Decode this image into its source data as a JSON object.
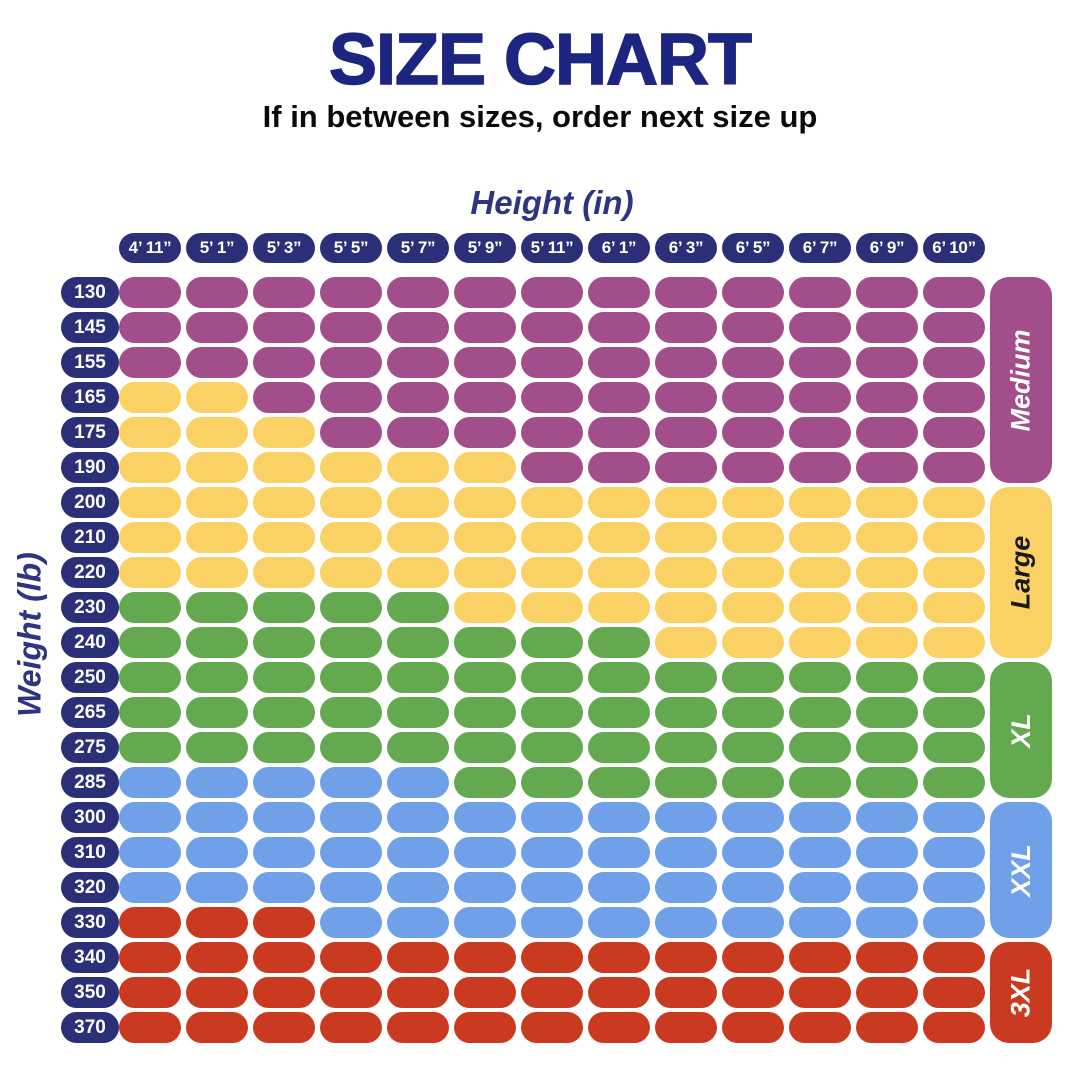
{
  "page": {
    "title": "SIZE CHART",
    "subtitle": "If in between sizes, order next size up"
  },
  "colors": {
    "background": "#FFFFFF",
    "title_text": "#1C2580",
    "subtitle_text": "#0A0A0A",
    "axis_label_text": "#2D3480",
    "tick_pill": "#2B2F78",
    "tick_text": "#FFFFFF"
  },
  "chart_data": {
    "type": "heatmap",
    "title": "SIZE CHART",
    "subtitle": "If in between sizes, order next size up",
    "xlabel": "Height (in)",
    "ylabel": "Weight (lb)",
    "legend_position": "right",
    "grid": "off",
    "x_categories": [
      "4’ 11”",
      "5’ 1”",
      "5’ 3”",
      "5’ 5”",
      "5’ 7”",
      "5’ 9”",
      "5’ 11”",
      "6’ 1”",
      "6’ 3”",
      "6’ 5”",
      "6’ 7”",
      "6’ 9”",
      "6’ 10”"
    ],
    "y_categories": [
      "130",
      "145",
      "155",
      "165",
      "175",
      "190",
      "200",
      "210",
      "220",
      "230",
      "240",
      "250",
      "265",
      "275",
      "285",
      "300",
      "310",
      "320",
      "330",
      "340",
      "350",
      "370"
    ],
    "sizes": [
      {
        "code": "M",
        "label": "Medium",
        "color": "#A14E8A",
        "text_color": "#FFFFFF",
        "row_start": 0,
        "row_end": 5
      },
      {
        "code": "L",
        "label": "Large",
        "color": "#FAD164",
        "text_color": "#1A1A1A",
        "row_start": 6,
        "row_end": 10
      },
      {
        "code": "XL",
        "label": "XL",
        "color": "#64A850",
        "text_color": "#FFFFFF",
        "row_start": 11,
        "row_end": 14
      },
      {
        "code": "XXL",
        "label": "XXL",
        "color": "#6FA0E8",
        "text_color": "#FFFFFF",
        "row_start": 15,
        "row_end": 18
      },
      {
        "code": "3XL",
        "label": "3XL",
        "color": "#C93A20",
        "text_color": "#FFFFFF",
        "row_start": 19,
        "row_end": 21
      }
    ],
    "matrix": [
      [
        "M",
        "M",
        "M",
        "M",
        "M",
        "M",
        "M",
        "M",
        "M",
        "M",
        "M",
        "M",
        "M"
      ],
      [
        "M",
        "M",
        "M",
        "M",
        "M",
        "M",
        "M",
        "M",
        "M",
        "M",
        "M",
        "M",
        "M"
      ],
      [
        "M",
        "M",
        "M",
        "M",
        "M",
        "M",
        "M",
        "M",
        "M",
        "M",
        "M",
        "M",
        "M"
      ],
      [
        "L",
        "L",
        "M",
        "M",
        "M",
        "M",
        "M",
        "M",
        "M",
        "M",
        "M",
        "M",
        "M"
      ],
      [
        "L",
        "L",
        "L",
        "M",
        "M",
        "M",
        "M",
        "M",
        "M",
        "M",
        "M",
        "M",
        "M"
      ],
      [
        "L",
        "L",
        "L",
        "L",
        "L",
        "L",
        "M",
        "M",
        "M",
        "M",
        "M",
        "M",
        "M"
      ],
      [
        "L",
        "L",
        "L",
        "L",
        "L",
        "L",
        "L",
        "L",
        "L",
        "L",
        "L",
        "L",
        "L"
      ],
      [
        "L",
        "L",
        "L",
        "L",
        "L",
        "L",
        "L",
        "L",
        "L",
        "L",
        "L",
        "L",
        "L"
      ],
      [
        "L",
        "L",
        "L",
        "L",
        "L",
        "L",
        "L",
        "L",
        "L",
        "L",
        "L",
        "L",
        "L"
      ],
      [
        "XL",
        "XL",
        "XL",
        "XL",
        "XL",
        "L",
        "L",
        "L",
        "L",
        "L",
        "L",
        "L",
        "L"
      ],
      [
        "XL",
        "XL",
        "XL",
        "XL",
        "XL",
        "XL",
        "XL",
        "XL",
        "L",
        "L",
        "L",
        "L",
        "L"
      ],
      [
        "XL",
        "XL",
        "XL",
        "XL",
        "XL",
        "XL",
        "XL",
        "XL",
        "XL",
        "XL",
        "XL",
        "XL",
        "XL"
      ],
      [
        "XL",
        "XL",
        "XL",
        "XL",
        "XL",
        "XL",
        "XL",
        "XL",
        "XL",
        "XL",
        "XL",
        "XL",
        "XL"
      ],
      [
        "XL",
        "XL",
        "XL",
        "XL",
        "XL",
        "XL",
        "XL",
        "XL",
        "XL",
        "XL",
        "XL",
        "XL",
        "XL"
      ],
      [
        "XXL",
        "XXL",
        "XXL",
        "XXL",
        "XXL",
        "XL",
        "XL",
        "XL",
        "XL",
        "XL",
        "XL",
        "XL",
        "XL"
      ],
      [
        "XXL",
        "XXL",
        "XXL",
        "XXL",
        "XXL",
        "XXL",
        "XXL",
        "XXL",
        "XXL",
        "XXL",
        "XXL",
        "XXL",
        "XXL"
      ],
      [
        "XXL",
        "XXL",
        "XXL",
        "XXL",
        "XXL",
        "XXL",
        "XXL",
        "XXL",
        "XXL",
        "XXL",
        "XXL",
        "XXL",
        "XXL"
      ],
      [
        "XXL",
        "XXL",
        "XXL",
        "XXL",
        "XXL",
        "XXL",
        "XXL",
        "XXL",
        "XXL",
        "XXL",
        "XXL",
        "XXL",
        "XXL"
      ],
      [
        "3XL",
        "3XL",
        "3XL",
        "XXL",
        "XXL",
        "XXL",
        "XXL",
        "XXL",
        "XXL",
        "XXL",
        "XXL",
        "XXL",
        "XXL"
      ],
      [
        "3XL",
        "3XL",
        "3XL",
        "3XL",
        "3XL",
        "3XL",
        "3XL",
        "3XL",
        "3XL",
        "3XL",
        "3XL",
        "3XL",
        "3XL"
      ],
      [
        "3XL",
        "3XL",
        "3XL",
        "3XL",
        "3XL",
        "3XL",
        "3XL",
        "3XL",
        "3XL",
        "3XL",
        "3XL",
        "3XL",
        "3XL"
      ],
      [
        "3XL",
        "3XL",
        "3XL",
        "3XL",
        "3XL",
        "3XL",
        "3XL",
        "3XL",
        "3XL",
        "3XL",
        "3XL",
        "3XL",
        "3XL"
      ]
    ],
    "layout": {
      "row_pitch": 35,
      "row_height": 31
    }
  }
}
